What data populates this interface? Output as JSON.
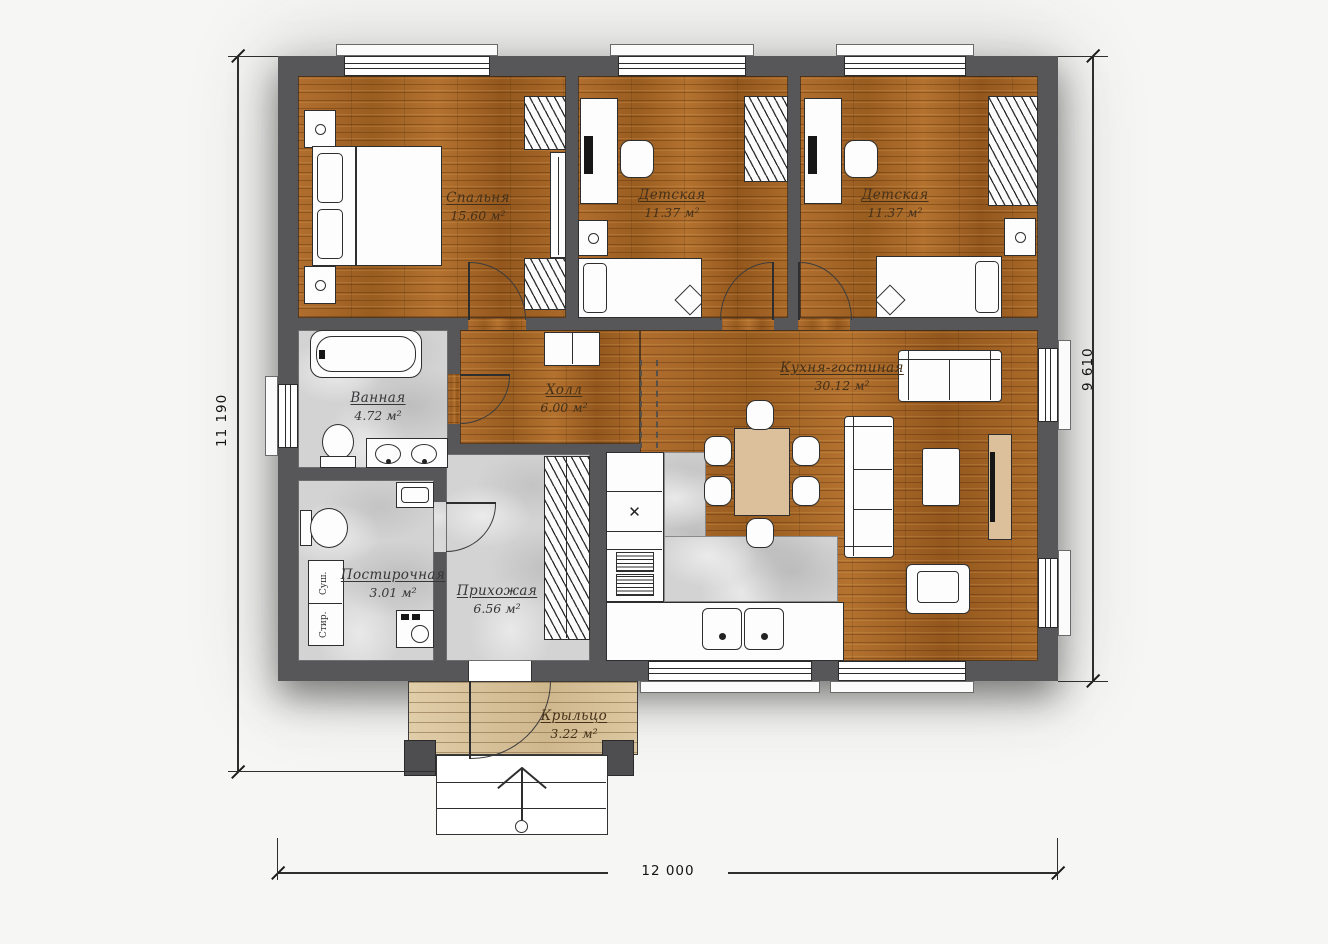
{
  "plan": {
    "type": "floor-plan",
    "floor_note": ""
  },
  "rooms": [
    {
      "name": "Спальня",
      "area": "15.60 м²"
    },
    {
      "name": "Детская",
      "area": "11.37 м²"
    },
    {
      "name": "Детская",
      "area": "11.37 м²"
    },
    {
      "name": "Холл",
      "area": "6.00 м²"
    },
    {
      "name": "Кухня-гостиная",
      "area": "30.12 м²"
    },
    {
      "name": "Ванная",
      "area": "4.72 м²"
    },
    {
      "name": "Постирочная",
      "area": "3.01 м²"
    },
    {
      "name": "Прихожая",
      "area": "6.56 м²"
    },
    {
      "name": "Крыльцо",
      "area": "3.22 м²"
    }
  ],
  "dimensions": {
    "left": "11 190",
    "right": "9 610",
    "bottom": "12 000"
  },
  "appliance_labels": {
    "dryer": "Суш.",
    "washer": "Стир."
  },
  "symbols": {
    "hob": "✕"
  },
  "colors": {
    "wall": "#57575a",
    "wood_floor": "#a5662a",
    "tile_floor": "#d3d3d3",
    "porch_deck": "#d8c19b",
    "furniture_wood": "#dcc09c",
    "paper": "#f6f6f4"
  }
}
